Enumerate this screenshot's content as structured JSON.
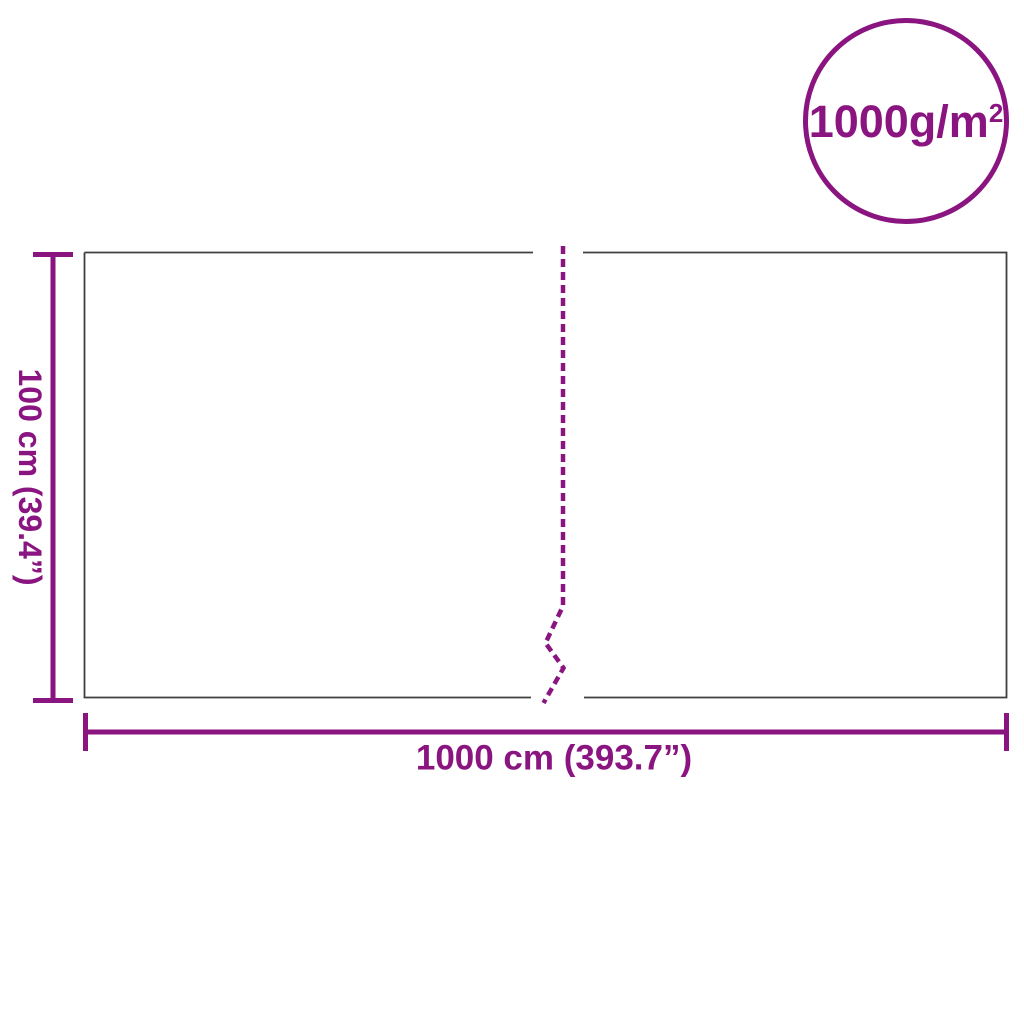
{
  "colors": {
    "accent": "#8A1580",
    "outline": "#3F3F3F",
    "background": "#FFFFFF"
  },
  "badge": {
    "value": "1000g/m",
    "superscript": "2",
    "full_text": "1000g/m²"
  },
  "dimensions": {
    "height": {
      "label": "100 cm (39.4”)",
      "value_cm": 100,
      "value_in": 39.4
    },
    "width": {
      "label": "1000 cm (393.7”)",
      "value_cm": 1000,
      "value_in": 393.7
    }
  },
  "icons": {
    "fold_line": "dashed-break-line",
    "height_dim": "vertical-dimension-line",
    "width_dim": "horizontal-dimension-line"
  }
}
